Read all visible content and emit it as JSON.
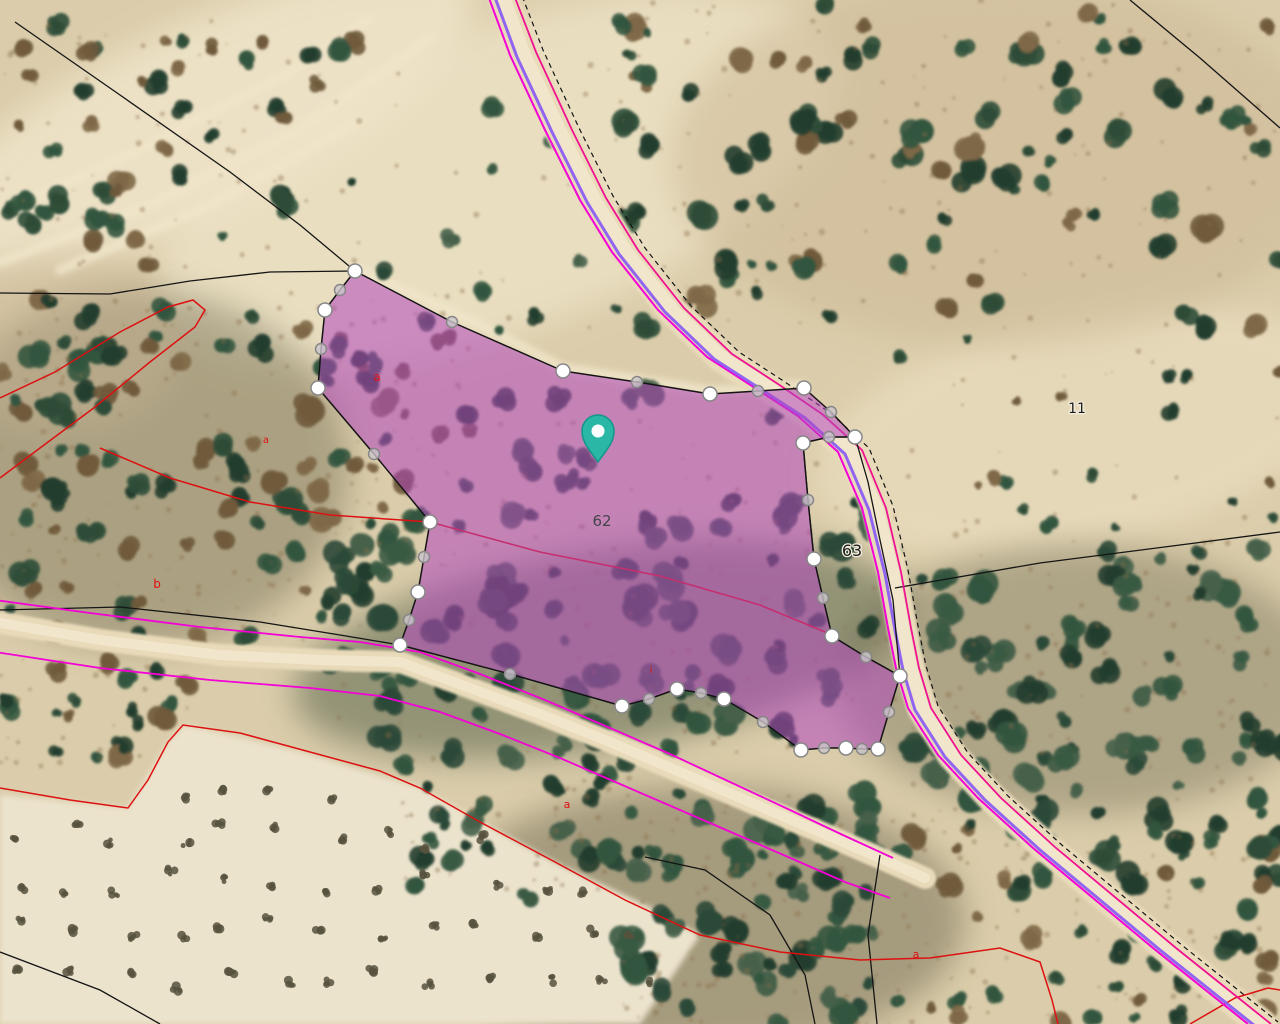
{
  "map": {
    "selected_parcel": {
      "number": "62",
      "label_pos": {
        "x": 602,
        "y": 526
      },
      "fill_color": "#b347bd",
      "fill_opacity": 0.55,
      "outline_color": "#141414",
      "boundary": [
        [
          355,
          271,
          "w"
        ],
        [
          452,
          322,
          "g"
        ],
        [
          563,
          371,
          "w"
        ],
        [
          637,
          382,
          "g"
        ],
        [
          710,
          394,
          "w"
        ],
        [
          758,
          391,
          "g"
        ],
        [
          804,
          388,
          "w"
        ],
        [
          831,
          412,
          "g"
        ],
        [
          855,
          437,
          "w"
        ],
        [
          829,
          437,
          "g"
        ],
        [
          803,
          443,
          "w"
        ],
        [
          808,
          500,
          "g"
        ],
        [
          814,
          559,
          "w"
        ],
        [
          823,
          598,
          "g"
        ],
        [
          832,
          636,
          "w"
        ],
        [
          866,
          657,
          "g"
        ],
        [
          900,
          676,
          "w"
        ],
        [
          889,
          712,
          "g"
        ],
        [
          878,
          749,
          "w"
        ],
        [
          862,
          749,
          "g"
        ],
        [
          846,
          748,
          "w"
        ],
        [
          824,
          748,
          "g"
        ],
        [
          801,
          750,
          "w"
        ],
        [
          763,
          722,
          "g"
        ],
        [
          724,
          699,
          "w"
        ],
        [
          701,
          693,
          "g"
        ],
        [
          677,
          689,
          "w"
        ],
        [
          649,
          699,
          "g"
        ],
        [
          622,
          706,
          "w"
        ],
        [
          510,
          674,
          "g"
        ],
        [
          400,
          645,
          "w"
        ],
        [
          409,
          620,
          "g"
        ],
        [
          418,
          592,
          "w"
        ],
        [
          424,
          557,
          "g"
        ],
        [
          430,
          522,
          "w"
        ],
        [
          374,
          454,
          "g"
        ],
        [
          318,
          388,
          "w"
        ],
        [
          321,
          349,
          "g"
        ],
        [
          325,
          310,
          "w"
        ],
        [
          340,
          290,
          "g"
        ]
      ],
      "inner_boundary_line": [
        [
          430,
          522
        ],
        [
          540,
          552
        ],
        [
          660,
          576
        ],
        [
          760,
          605
        ],
        [
          830,
          634
        ]
      ]
    },
    "neighbor_parcels": [
      {
        "number": "63",
        "label_pos": {
          "x": 852,
          "y": 556
        },
        "outline": [
          [
            855,
            437
          ],
          [
            829,
            437
          ],
          [
            803,
            443
          ],
          [
            808,
            500
          ],
          [
            814,
            559
          ],
          [
            823,
            598
          ],
          [
            832,
            636
          ],
          [
            866,
            657
          ],
          [
            900,
            676
          ],
          [
            893,
            600
          ],
          [
            880,
            540
          ],
          [
            868,
            482
          ]
        ]
      },
      {
        "number": "11",
        "label_pos": {
          "x": 1077,
          "y": 413
        }
      }
    ],
    "parcel_label_color": "#44444e",
    "neighbor_label_color": "#1c1c1c",
    "subparcel_labels": [
      {
        "text": "a",
        "x": 377,
        "y": 381,
        "size": 12
      },
      {
        "text": "a",
        "x": 266,
        "y": 443,
        "size": 10
      },
      {
        "text": "b",
        "x": 157,
        "y": 588,
        "size": 12
      },
      {
        "text": "i",
        "x": 651,
        "y": 673,
        "size": 10
      },
      {
        "text": "a",
        "x": 567,
        "y": 808,
        "size": 11
      },
      {
        "text": "a",
        "x": 916,
        "y": 958,
        "size": 11
      }
    ],
    "subparcel_label_color": "#dd1111",
    "marker_pin": {
      "x": 598,
      "y": 462,
      "fill": "#2bb7a5",
      "stroke": "#13968a",
      "center_dot": "#ffffff"
    },
    "handle_style": {
      "white_fill": "#ffffff",
      "gray_fill": "#cbc5cb",
      "stroke": "#878787"
    },
    "line_colors": {
      "road_magenta_west": "#f400d6",
      "road_magenta_east": "#f01290",
      "road_violet": "#8b5ef2",
      "cadastral_black": "#151515",
      "sigpac_red": "#dd1111"
    }
  }
}
